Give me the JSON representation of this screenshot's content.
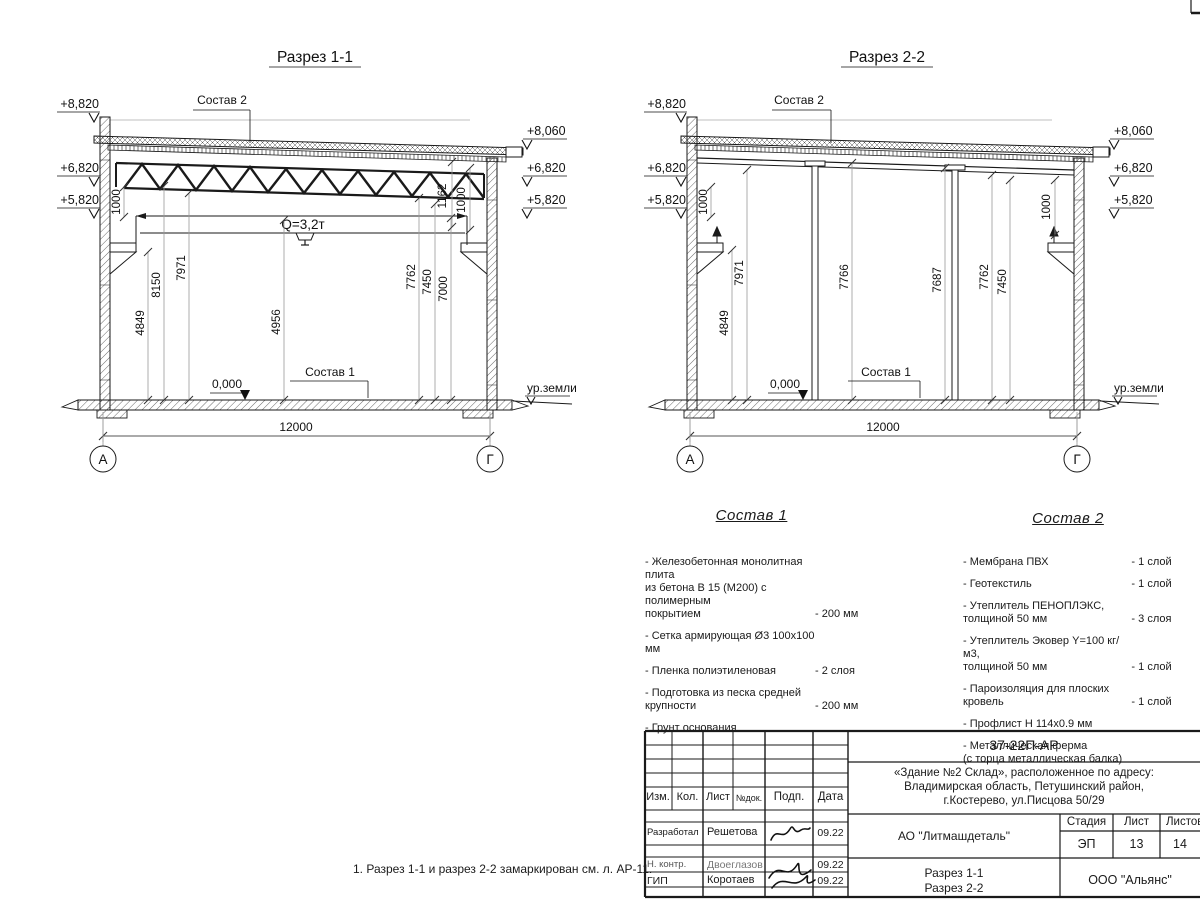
{
  "c": {
    "e8820": "+8,820",
    "e8060": "+8,060",
    "e6820": "+6,820",
    "e5820": "+5,820",
    "d1000": "1000",
    "span": "12000",
    "zero": "0,000",
    "ground": "ур.земли",
    "sostav1_label": "Состав 1",
    "sostav2_label": "Состав 2",
    "axisA": "А",
    "axisG": "Г"
  },
  "s1": {
    "title": "Разрез 1-1",
    "crane": "Q=3,2т",
    "d4849": "4849",
    "d8150": "8150",
    "d7971": "7971",
    "d4956": "4956",
    "d7762": "7762",
    "d7450": "7450",
    "d7000": "7000",
    "d1162": "1162"
  },
  "s2": {
    "title": "Разрез 2-2",
    "d4849": "4849",
    "d7971": "7971",
    "d7766": "7766",
    "d7687": "7687",
    "d7762": "7762",
    "d7450": "7450"
  },
  "sostav1": {
    "title": "Состав 1",
    "items": [
      {
        "name": "- Железобетонная  монолитная плита\nиз бетона В 15 (М200) с полимерным\nпокрытием",
        "qty": "- 200 мм"
      },
      {
        "name": "- Сетка армирующая Ø3 100х100 мм",
        "qty": ""
      },
      {
        "name": "- Пленка полиэтиленовая",
        "qty": "-  2 слоя"
      },
      {
        "name": "- Подготовка из песка средней\n  крупности",
        "qty": "- 200 мм"
      },
      {
        "name": "- Грунт основания",
        "qty": ""
      }
    ]
  },
  "sostav2": {
    "title": "Состав 2",
    "items": [
      {
        "name": "- Мембрана ПВХ",
        "qty": "- 1 слой"
      },
      {
        "name": "- Геотекстиль",
        "qty": "- 1 слой"
      },
      {
        "name": "- Утеплитель ПЕНОПЛЭКС,\n  толщиной 50 мм",
        "qty": "- 3 слоя"
      },
      {
        "name": "- Утеплитель Эковер Y=100 кг/м3,\n  толщиной 50 мм",
        "qty": "- 1 слой"
      },
      {
        "name": "- Пароизоляция для плоских кровель",
        "qty": "- 1 слой"
      },
      {
        "name": "- Профлист Н 114х0.9 мм",
        "qty": ""
      },
      {
        "name": "- Металлическая ферма\n  (с торца металлическая балка)",
        "qty": ""
      }
    ]
  },
  "note": "1. Разрез 1-1 и разрез 2-2 замаркирован см. л. АР-11.",
  "tb": {
    "doc": "37-22П-АР",
    "object": "«Здание №2 Склад», расположенное по адресу:\nВладимирская область, Петушинский район,\nг.Костерево, ул.Писцова 50/29",
    "customer": "АО \"Литмашдеталь\"",
    "sheet_name": "Разрез 1-1\nРазрез 2-2",
    "company": "ООО \"Альянс\"",
    "stage_label": "Стадия",
    "list_label": "Лист",
    "listov_label": "Листов",
    "stage": "ЭП",
    "list": "13",
    "listov": "14",
    "h_izm": "Изм.",
    "h_kol": "Кол.",
    "h_list": "Лист",
    "h_ndok": "№док.",
    "h_podp": "Подп.",
    "h_data": "Дата",
    "r1_role": "Разработал",
    "r1_name": "Решетова",
    "r1_date": "09.22",
    "r2_role": "Н. контр.",
    "r2_name": "Двоеглазов",
    "r2_date": "09.22",
    "r3_role": "ГИП",
    "r3_name": "Коротаев",
    "r3_date": "09.22"
  }
}
